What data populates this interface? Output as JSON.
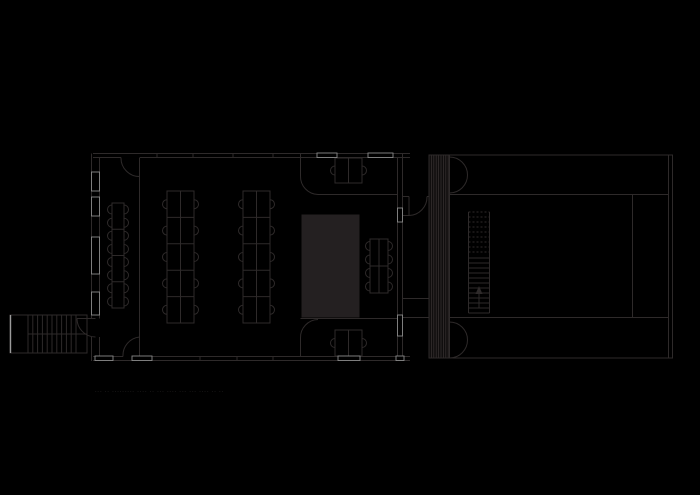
{
  "meta": {
    "width": 700,
    "height": 495,
    "background": "#000000",
    "drawing_type": "architectural-floor-plan"
  },
  "colors": {
    "background": "#000000",
    "line": "#2e2a2a",
    "core_fill": "#242021",
    "bright": "#9b9b9b",
    "bright_soft": "#8a8a8a",
    "caption": "#454040",
    "hatch_band": "#100e0e",
    "hatch_line": "#353030"
  },
  "caption": {
    "text": "--- --  ---------  ----   -- ---  ----  --- ---  ----  --  --"
  },
  "plan": {
    "lines": [
      [
        93,
        153.5,
        410,
        153.5
      ],
      [
        93,
        157.5,
        121,
        157.5
      ],
      [
        140,
        157.5,
        410,
        157.5
      ],
      [
        91.5,
        153.5,
        91.5,
        318.5
      ],
      [
        91.5,
        337,
        91.5,
        361
      ],
      [
        99.5,
        158,
        99.5,
        318.5
      ],
      [
        99.5,
        337,
        99.5,
        356
      ],
      [
        402.5,
        153.5,
        402.5,
        361
      ],
      [
        397.5,
        158,
        397.5,
        356
      ],
      [
        93,
        360.5,
        410,
        360.5
      ],
      [
        93,
        356.5,
        123,
        356.5
      ],
      [
        140,
        356.5,
        410,
        356.5
      ],
      [
        139.5,
        157.5,
        139.5,
        356.5
      ],
      [
        300.5,
        153.5,
        300.5,
        176
      ],
      [
        318,
        194.5,
        397.5,
        194.5
      ],
      [
        300.5,
        338,
        300.5,
        356.5
      ],
      [
        300.5,
        318.5,
        397.5,
        318.5
      ],
      [
        157,
        153.5,
        157,
        157.5
      ],
      [
        193,
        153.5,
        193,
        157.5
      ],
      [
        233,
        153.5,
        233,
        157.5
      ],
      [
        273,
        153.5,
        273,
        157.5
      ],
      [
        200,
        356.5,
        200,
        360.5
      ],
      [
        237,
        356.5,
        237,
        360.5
      ],
      [
        273,
        356.5,
        273,
        360.5
      ],
      [
        348.5,
        158,
        348.5,
        183
      ],
      [
        348.5,
        330,
        348.5,
        356
      ],
      [
        112,
        229.25,
        124,
        229.25
      ],
      [
        112,
        255.5,
        124,
        255.5
      ],
      [
        112,
        281.75,
        124,
        281.75
      ],
      [
        180.5,
        191,
        180.5,
        323
      ],
      [
        167,
        217.4,
        194,
        217.4
      ],
      [
        167,
        243.8,
        194,
        243.8
      ],
      [
        167,
        270.2,
        194,
        270.2
      ],
      [
        167,
        296.6,
        194,
        296.6
      ],
      [
        256.5,
        191,
        256.5,
        323
      ],
      [
        243,
        217.4,
        270,
        217.4
      ],
      [
        243,
        243.8,
        270,
        243.8
      ],
      [
        243,
        270.2,
        270,
        270.2
      ],
      [
        243,
        296.6,
        270,
        296.6
      ],
      [
        379,
        239,
        379,
        293
      ],
      [
        370,
        266,
        388,
        266
      ],
      [
        28,
        334,
        87,
        334
      ],
      [
        28,
        315,
        28,
        353
      ],
      [
        32.8,
        315,
        32.8,
        353
      ],
      [
        37.6,
        315,
        37.6,
        353
      ],
      [
        42.4,
        315,
        42.4,
        353
      ],
      [
        47.2,
        315,
        47.2,
        353
      ],
      [
        52,
        315,
        52,
        353
      ],
      [
        56.8,
        315,
        56.8,
        353
      ],
      [
        61.6,
        315,
        61.6,
        353
      ],
      [
        66.4,
        315,
        66.4,
        353
      ],
      [
        71.2,
        315,
        71.2,
        353
      ],
      [
        76,
        315,
        76,
        353
      ],
      [
        77,
        318.5,
        95.5,
        318.5
      ],
      [
        403,
        196.5,
        409,
        196.5
      ],
      [
        427,
        196.5,
        429,
        196.5
      ],
      [
        403,
        215.5,
        409,
        215.5
      ],
      [
        409,
        196.5,
        409,
        215.5
      ],
      [
        403,
        298.5,
        429,
        298.5
      ],
      [
        403,
        317.5,
        429,
        317.5
      ],
      [
        449.5,
        155,
        449.5,
        358
      ],
      [
        449.5,
        194.5,
        668.5,
        194.5
      ],
      [
        449.5,
        317.5,
        668.5,
        317.5
      ],
      [
        632.5,
        194.5,
        632.5,
        317.5
      ],
      [
        668.5,
        155,
        668.5,
        358
      ],
      [
        468.5,
        212,
        468.5,
        313
      ],
      [
        489.5,
        212,
        489.5,
        313
      ],
      [
        468.5,
        258,
        489.5,
        258
      ],
      [
        468.5,
        263,
        489.5,
        263
      ],
      [
        468.5,
        268,
        489.5,
        268
      ],
      [
        468.5,
        273,
        489.5,
        273
      ],
      [
        468.5,
        278,
        489.5,
        278
      ],
      [
        468.5,
        283,
        489.5,
        283
      ],
      [
        468.5,
        288,
        489.5,
        288
      ],
      [
        468.5,
        293,
        489.5,
        293
      ],
      [
        468.5,
        298,
        489.5,
        298
      ],
      [
        468.5,
        303,
        489.5,
        303
      ],
      [
        468.5,
        308,
        489.5,
        308
      ],
      [
        468.5,
        313,
        489.5,
        313
      ],
      [
        479,
        308,
        479,
        290
      ]
    ],
    "dashed": [
      [
        468.5,
        212,
        489.5,
        212
      ],
      [
        468.5,
        217,
        489.5,
        217
      ],
      [
        468.5,
        222,
        489.5,
        222
      ],
      [
        468.5,
        227,
        489.5,
        227
      ],
      [
        468.5,
        232,
        489.5,
        232
      ],
      [
        468.5,
        237,
        489.5,
        237
      ],
      [
        468.5,
        242,
        489.5,
        242
      ],
      [
        468.5,
        247,
        489.5,
        247
      ],
      [
        468.5,
        252,
        489.5,
        252
      ]
    ],
    "rects": [
      [
        112,
        203,
        12,
        105
      ],
      [
        167,
        191,
        27,
        132
      ],
      [
        243,
        191,
        27,
        132
      ],
      [
        370,
        239,
        18,
        54
      ],
      [
        335,
        158,
        27,
        25
      ],
      [
        335,
        330,
        27,
        26
      ],
      [
        10,
        315,
        77,
        38
      ],
      [
        429,
        155,
        243.5,
        203
      ]
    ],
    "filled_rects": [
      [
        302,
        215,
        57,
        102
      ]
    ],
    "bright_rects": [
      [
        91.5,
        172,
        8,
        19
      ],
      [
        91.5,
        197,
        8,
        19
      ],
      [
        91.5,
        237,
        8,
        37
      ],
      [
        91.5,
        292,
        8,
        23
      ],
      [
        397.5,
        208,
        5,
        14
      ],
      [
        397.5,
        315,
        5,
        21
      ],
      [
        95,
        356,
        18,
        4.5
      ],
      [
        132,
        356,
        20,
        4.5
      ],
      [
        338,
        356,
        22,
        4.5
      ],
      [
        396,
        356,
        8,
        4.5
      ],
      [
        317,
        153,
        20,
        4.5
      ],
      [
        368,
        153,
        25,
        4.5
      ]
    ],
    "bright_lines": [
      [
        10.5,
        315,
        10.5,
        353
      ]
    ],
    "arcs": [
      "M121,157.5 A18.5,18.5 0 0 0 139.5,176.5",
      "M123,356.5 A18.5,18.5 0 0 1 139.5,337",
      "M77,318.5 A18.5,18.5 0 0 0 95.5,337",
      "M300.5,176 A18,18 0 0 0 318,194.5",
      "M300.5,338 A18,18 0 0 1 318,319.5",
      "M409,215.5 A18.5,18.5 0 0 0 427,196.5",
      "M449.5,157 A18,18 0 0 1 467.5,175",
      "M449.5,193 A18,18 0 0 0 467.5,175",
      "M449.5,322 A18,18 0 0 1 467.5,340",
      "M449.5,358 A18,18 0 0 0 467.5,340"
    ],
    "hatch": {
      "x": 429,
      "y": 155,
      "w": 20.5,
      "h": 203,
      "step": 2.4
    },
    "arrow_head": [
      [
        479,
        286
      ],
      [
        475.5,
        294
      ],
      [
        482.5,
        294
      ]
    ],
    "chairs": [
      [
        112,
        209.5,
        "W"
      ],
      [
        112,
        222.75,
        "W"
      ],
      [
        112,
        235.75,
        "W"
      ],
      [
        112,
        249,
        "W"
      ],
      [
        112,
        262,
        "W"
      ],
      [
        112,
        275.25,
        "W"
      ],
      [
        112,
        288.25,
        "W"
      ],
      [
        112,
        301.5,
        "W"
      ],
      [
        124,
        209.5,
        "E"
      ],
      [
        124,
        222.75,
        "E"
      ],
      [
        124,
        235.75,
        "E"
      ],
      [
        124,
        249,
        "E"
      ],
      [
        124,
        262,
        "E"
      ],
      [
        124,
        275.25,
        "E"
      ],
      [
        124,
        288.25,
        "E"
      ],
      [
        124,
        301.5,
        "E"
      ],
      [
        167,
        204.2,
        "W"
      ],
      [
        167,
        230.6,
        "W"
      ],
      [
        167,
        257,
        "W"
      ],
      [
        167,
        283.4,
        "W"
      ],
      [
        167,
        309.8,
        "W"
      ],
      [
        194,
        204.2,
        "E"
      ],
      [
        194,
        230.6,
        "E"
      ],
      [
        194,
        257,
        "E"
      ],
      [
        194,
        283.4,
        "E"
      ],
      [
        194,
        309.8,
        "E"
      ],
      [
        243,
        204.2,
        "W"
      ],
      [
        243,
        230.6,
        "W"
      ],
      [
        243,
        257,
        "W"
      ],
      [
        243,
        283.4,
        "W"
      ],
      [
        243,
        309.8,
        "W"
      ],
      [
        270,
        204.2,
        "E"
      ],
      [
        270,
        230.6,
        "E"
      ],
      [
        270,
        257,
        "E"
      ],
      [
        270,
        283.4,
        "E"
      ],
      [
        270,
        309.8,
        "E"
      ],
      [
        370,
        246,
        "W"
      ],
      [
        370,
        259.5,
        "W"
      ],
      [
        370,
        273,
        "W"
      ],
      [
        370,
        286.5,
        "W"
      ],
      [
        388,
        246,
        "E"
      ],
      [
        388,
        259.5,
        "E"
      ],
      [
        388,
        273,
        "E"
      ],
      [
        388,
        286.5,
        "E"
      ],
      [
        335,
        170.5,
        "W"
      ],
      [
        362,
        170.5,
        "E"
      ],
      [
        335,
        343,
        "W"
      ],
      [
        362,
        343,
        "E"
      ]
    ]
  }
}
